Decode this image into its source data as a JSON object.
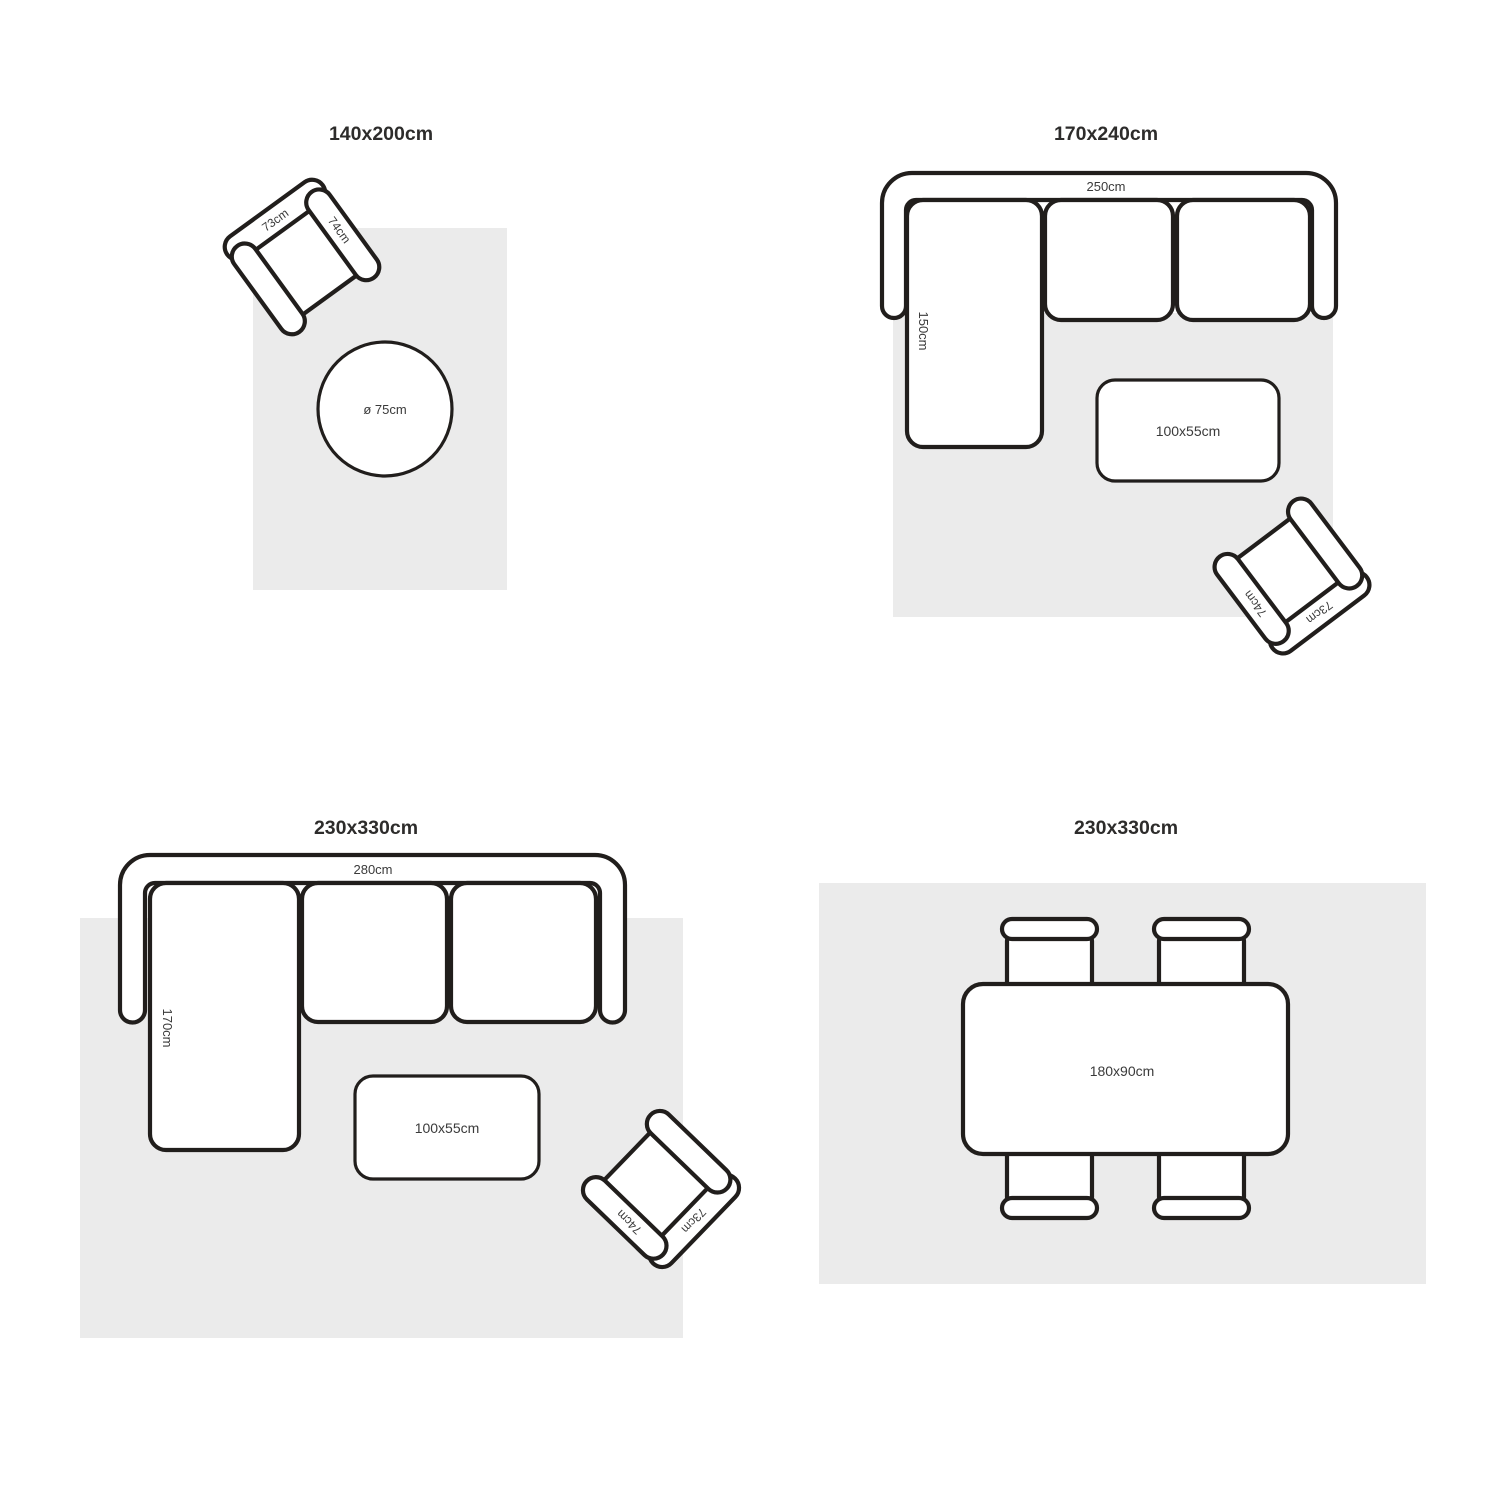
{
  "colors": {
    "background": "#ffffff",
    "rug": "#ebebeb",
    "line": "#211e1c",
    "title_text": "#2d2c2b",
    "label_text": "#3a3a3a"
  },
  "layouts": [
    {
      "id": "top-left",
      "title": "140x200cm",
      "armchair": {
        "back_label": "73cm",
        "arm_label": "74cm"
      },
      "side_table_label": "ø 75cm"
    },
    {
      "id": "top-right",
      "title": "170x240cm",
      "sofa": {
        "width_label": "250cm",
        "depth_label": "150cm"
      },
      "coffee_table_label": "100x55cm",
      "armchair": {
        "back_label": "73cm",
        "arm_label": "74cm"
      }
    },
    {
      "id": "bottom-left",
      "title": "230x330cm",
      "sofa": {
        "width_label": "280cm",
        "depth_label": "170cm"
      },
      "coffee_table_label": "100x55cm",
      "armchair": {
        "back_label": "73cm",
        "arm_label": "74cm"
      }
    },
    {
      "id": "bottom-right",
      "title": "230x330cm",
      "dining_table_label": "180x90cm"
    }
  ]
}
